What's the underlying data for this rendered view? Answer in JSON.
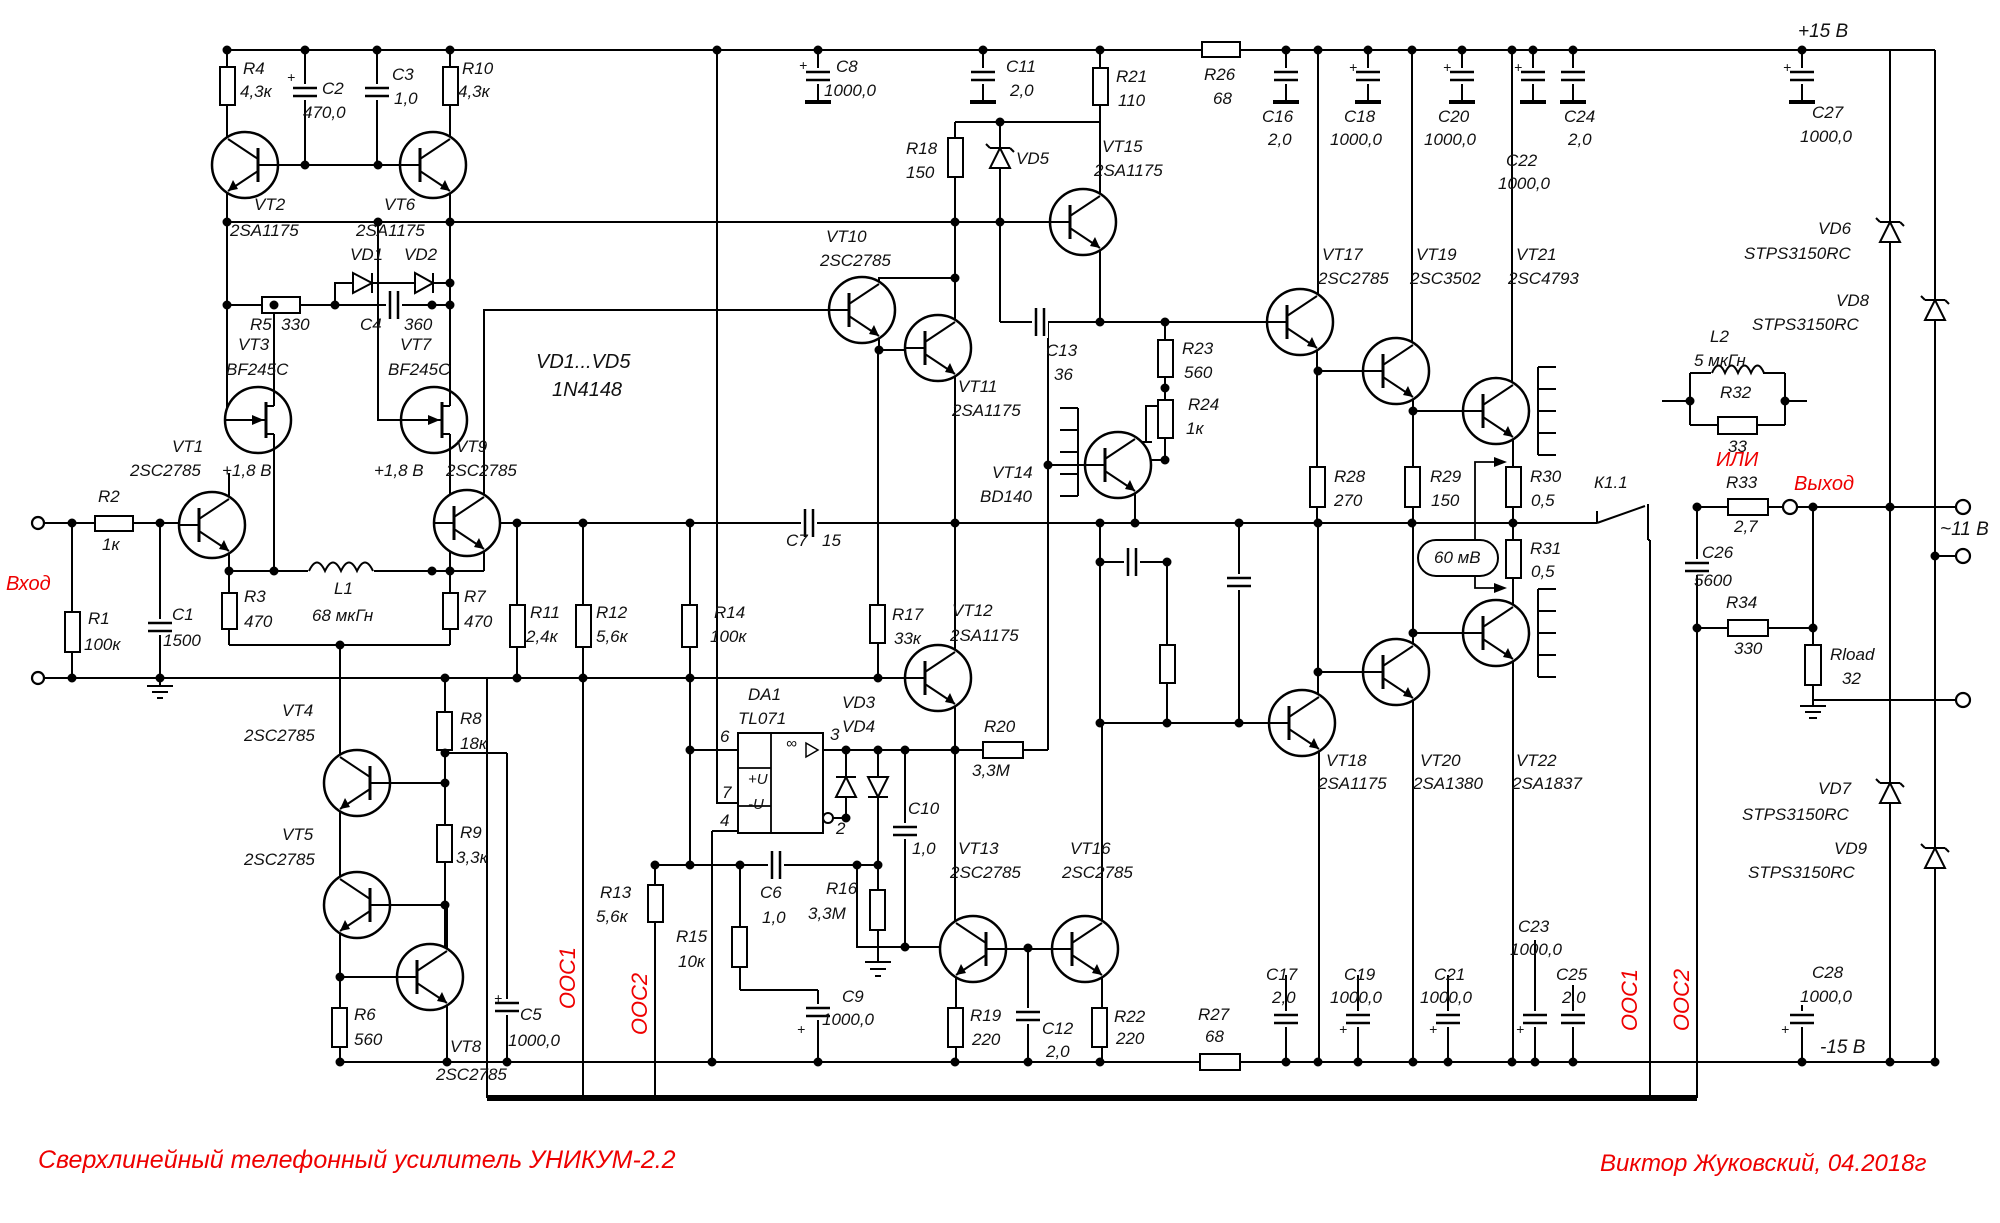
{
  "title": "Сверхлинейный телефонный усилитель УНИКУМ-2.2",
  "author": "Виктор Жуковский, 04.2018г",
  "colors": {
    "wire": "#000000",
    "label": "#111111",
    "accent": "#ee0000",
    "bg": "#ffffff"
  },
  "power": {
    "pos_rail": "+15 В",
    "neg_rail": "-15 В",
    "output_voltage": "~11 В"
  },
  "net_labels": [
    "Вход",
    "Выход",
    "ИЛИ",
    "ООС1",
    "ООС2",
    "60 мВ",
    "К1.1",
    "+1,8 В"
  ],
  "ic": {
    "ref": "DA1",
    "part": "TL071",
    "pins": [
      "6",
      "7",
      "4",
      "3",
      "2"
    ],
    "cells": [
      "+U",
      "-U",
      "∞"
    ]
  },
  "labels": [
    {
      "t": "R4",
      "x": 243,
      "y": 60
    },
    {
      "t": "4,3к",
      "x": 240,
      "y": 83
    },
    {
      "t": "C2",
      "x": 322,
      "y": 80
    },
    {
      "t": "470,0",
      "x": 303,
      "y": 104
    },
    {
      "t": "C3",
      "x": 392,
      "y": 66
    },
    {
      "t": "1,0",
      "x": 394,
      "y": 90
    },
    {
      "t": "R10",
      "x": 462,
      "y": 60
    },
    {
      "t": "4,3к",
      "x": 458,
      "y": 83
    },
    {
      "t": "VT2",
      "x": 254,
      "y": 196
    },
    {
      "t": "2SA1175",
      "x": 230,
      "y": 222
    },
    {
      "t": "VT6",
      "x": 384,
      "y": 196
    },
    {
      "t": "2SA1175",
      "x": 356,
      "y": 222
    },
    {
      "t": "VD1",
      "x": 350,
      "y": 246
    },
    {
      "t": "VD2",
      "x": 404,
      "y": 246
    },
    {
      "t": "R5  330",
      "x": 250,
      "y": 316
    },
    {
      "t": "C4",
      "x": 360,
      "y": 316
    },
    {
      "t": "360",
      "x": 404,
      "y": 316
    },
    {
      "t": "VT3",
      "x": 238,
      "y": 336
    },
    {
      "t": "BF245C",
      "x": 226,
      "y": 361
    },
    {
      "t": "VT7",
      "x": 400,
      "y": 336
    },
    {
      "t": "BF245C",
      "x": 388,
      "y": 361
    },
    {
      "t": "VD1...VD5",
      "x": 536,
      "y": 352,
      "s": 20
    },
    {
      "t": "1N4148",
      "x": 552,
      "y": 380,
      "s": 20
    },
    {
      "t": "VT1",
      "x": 172,
      "y": 438
    },
    {
      "t": "2SC2785",
      "x": 130,
      "y": 462
    },
    {
      "t": "+1,8 В",
      "x": 222,
      "y": 462
    },
    {
      "t": "+1,8 В",
      "x": 374,
      "y": 462
    },
    {
      "t": "VT9",
      "x": 456,
      "y": 438
    },
    {
      "t": "2SC2785",
      "x": 446,
      "y": 462
    },
    {
      "t": "R2",
      "x": 98,
      "y": 488
    },
    {
      "t": "1к",
      "x": 102,
      "y": 536
    },
    {
      "t": "Вход",
      "x": 6,
      "y": 574,
      "c": "r",
      "s": 20
    },
    {
      "t": "R1",
      "x": 88,
      "y": 610
    },
    {
      "t": "100к",
      "x": 84,
      "y": 636
    },
    {
      "t": "C1",
      "x": 172,
      "y": 606
    },
    {
      "t": "1500",
      "x": 163,
      "y": 632
    },
    {
      "t": "R3",
      "x": 244,
      "y": 588
    },
    {
      "t": "470",
      "x": 244,
      "y": 613
    },
    {
      "t": "L1",
      "x": 334,
      "y": 580
    },
    {
      "t": "68 мкГн",
      "x": 312,
      "y": 607
    },
    {
      "t": "R7",
      "x": 464,
      "y": 588
    },
    {
      "t": "470",
      "x": 464,
      "y": 613
    },
    {
      "t": "VT4",
      "x": 282,
      "y": 702
    },
    {
      "t": "2SC2785",
      "x": 244,
      "y": 727
    },
    {
      "t": "VT5",
      "x": 282,
      "y": 826
    },
    {
      "t": "2SC2785",
      "x": 244,
      "y": 851
    },
    {
      "t": "R8",
      "x": 460,
      "y": 710
    },
    {
      "t": "18к",
      "x": 460,
      "y": 735
    },
    {
      "t": "R9",
      "x": 460,
      "y": 824
    },
    {
      "t": "3,3к",
      "x": 456,
      "y": 849
    },
    {
      "t": "R6",
      "x": 354,
      "y": 1006
    },
    {
      "t": "560",
      "x": 354,
      "y": 1031
    },
    {
      "t": "VT8",
      "x": 450,
      "y": 1038
    },
    {
      "t": "2SC2785",
      "x": 436,
      "y": 1066
    },
    {
      "t": "C5",
      "x": 520,
      "y": 1006
    },
    {
      "t": "1000,0",
      "x": 508,
      "y": 1032
    },
    {
      "t": "ООС1",
      "x": 568,
      "y": 978,
      "c": "r",
      "s": 22,
      "v": 1
    },
    {
      "t": "ООС2",
      "x": 640,
      "y": 1004,
      "c": "r",
      "s": 22,
      "v": 1
    },
    {
      "t": "R13",
      "x": 600,
      "y": 884
    },
    {
      "t": "5,6к",
      "x": 596,
      "y": 908
    },
    {
      "t": "R15",
      "x": 676,
      "y": 928
    },
    {
      "t": "10к",
      "x": 678,
      "y": 953
    },
    {
      "t": "R11",
      "x": 530,
      "y": 604
    },
    {
      "t": "2,4к",
      "x": 526,
      "y": 628
    },
    {
      "t": "R12",
      "x": 596,
      "y": 604
    },
    {
      "t": "5,6к",
      "x": 596,
      "y": 628
    },
    {
      "t": "R14",
      "x": 714,
      "y": 604
    },
    {
      "t": "100к",
      "x": 710,
      "y": 628
    },
    {
      "t": "C7",
      "x": 786,
      "y": 532
    },
    {
      "t": "15",
      "x": 822,
      "y": 532
    },
    {
      "t": "DA1",
      "x": 748,
      "y": 686
    },
    {
      "t": "TL071",
      "x": 738,
      "y": 710
    },
    {
      "t": "6",
      "x": 720,
      "y": 728
    },
    {
      "t": "7",
      "x": 722,
      "y": 784
    },
    {
      "t": "4",
      "x": 720,
      "y": 812
    },
    {
      "t": "3",
      "x": 830,
      "y": 726
    },
    {
      "t": "2",
      "x": 836,
      "y": 820
    },
    {
      "t": "+U",
      "x": 748,
      "y": 772,
      "s": 15
    },
    {
      "t": "-U",
      "x": 748,
      "y": 797,
      "s": 15
    },
    {
      "t": "∞",
      "x": 786,
      "y": 736,
      "s": 15
    },
    {
      "t": "VD3",
      "x": 842,
      "y": 694
    },
    {
      "t": "VD4",
      "x": 842,
      "y": 718
    },
    {
      "t": "C10",
      "x": 908,
      "y": 800
    },
    {
      "t": "1,0",
      "x": 912,
      "y": 840
    },
    {
      "t": "C6",
      "x": 760,
      "y": 884
    },
    {
      "t": "1,0",
      "x": 762,
      "y": 909
    },
    {
      "t": "R16",
      "x": 826,
      "y": 880
    },
    {
      "t": "3,3М",
      "x": 808,
      "y": 905
    },
    {
      "t": "R17",
      "x": 892,
      "y": 606
    },
    {
      "t": "33к",
      "x": 894,
      "y": 630
    },
    {
      "t": "VT12",
      "x": 952,
      "y": 602
    },
    {
      "t": "2SA1175",
      "x": 950,
      "y": 627
    },
    {
      "t": "R20",
      "x": 984,
      "y": 718
    },
    {
      "t": "3,3М",
      "x": 972,
      "y": 762
    },
    {
      "t": "VT13",
      "x": 958,
      "y": 840
    },
    {
      "t": "2SC2785",
      "x": 950,
      "y": 864
    },
    {
      "t": "VT16",
      "x": 1070,
      "y": 840
    },
    {
      "t": "2SC2785",
      "x": 1062,
      "y": 864
    },
    {
      "t": "C9",
      "x": 842,
      "y": 988
    },
    {
      "t": "1000,0",
      "x": 822,
      "y": 1011
    },
    {
      "t": "R19",
      "x": 970,
      "y": 1007
    },
    {
      "t": "220",
      "x": 972,
      "y": 1031
    },
    {
      "t": "C12",
      "x": 1042,
      "y": 1020
    },
    {
      "t": "2,0",
      "x": 1046,
      "y": 1043
    },
    {
      "t": "R22",
      "x": 1114,
      "y": 1008
    },
    {
      "t": "220",
      "x": 1116,
      "y": 1030
    },
    {
      "t": "R27",
      "x": 1198,
      "y": 1006
    },
    {
      "t": "68",
      "x": 1205,
      "y": 1028
    },
    {
      "t": "C8",
      "x": 836,
      "y": 58
    },
    {
      "t": "1000,0",
      "x": 824,
      "y": 82
    },
    {
      "t": "C11",
      "x": 1006,
      "y": 58
    },
    {
      "t": "2,0",
      "x": 1010,
      "y": 82
    },
    {
      "t": "R18",
      "x": 906,
      "y": 140
    },
    {
      "t": "150",
      "x": 906,
      "y": 164
    },
    {
      "t": "VD5",
      "x": 1016,
      "y": 150
    },
    {
      "t": "VT10",
      "x": 826,
      "y": 228
    },
    {
      "t": "2SC2785",
      "x": 820,
      "y": 252
    },
    {
      "t": "VT11",
      "x": 958,
      "y": 378
    },
    {
      "t": "2SA1175",
      "x": 952,
      "y": 402
    },
    {
      "t": "C13",
      "x": 1046,
      "y": 342
    },
    {
      "t": "36",
      "x": 1054,
      "y": 366
    },
    {
      "t": "VT14",
      "x": 992,
      "y": 464
    },
    {
      "t": "BD140",
      "x": 980,
      "y": 488
    },
    {
      "t": "R23",
      "x": 1182,
      "y": 340
    },
    {
      "t": "560",
      "x": 1184,
      "y": 364
    },
    {
      "t": "R24",
      "x": 1188,
      "y": 396
    },
    {
      "t": "1к",
      "x": 1186,
      "y": 420
    },
    {
      "t": "VT15",
      "x": 1102,
      "y": 138
    },
    {
      "t": "2SA1175",
      "x": 1094,
      "y": 162
    },
    {
      "t": "R21",
      "x": 1116,
      "y": 68
    },
    {
      "t": "110",
      "x": 1118,
      "y": 92
    },
    {
      "t": "R26",
      "x": 1204,
      "y": 66
    },
    {
      "t": "68",
      "x": 1213,
      "y": 90
    },
    {
      "t": "C16",
      "x": 1262,
      "y": 108
    },
    {
      "t": "2,0",
      "x": 1268,
      "y": 131
    },
    {
      "t": "C18",
      "x": 1344,
      "y": 108
    },
    {
      "t": "1000,0",
      "x": 1330,
      "y": 131
    },
    {
      "t": "C20",
      "x": 1438,
      "y": 108
    },
    {
      "t": "1000,0",
      "x": 1424,
      "y": 131
    },
    {
      "t": "C22",
      "x": 1506,
      "y": 152
    },
    {
      "t": "1000,0",
      "x": 1498,
      "y": 175
    },
    {
      "t": "C24",
      "x": 1564,
      "y": 108
    },
    {
      "t": "2,0",
      "x": 1568,
      "y": 131
    },
    {
      "t": "C27",
      "x": 1812,
      "y": 104
    },
    {
      "t": "1000,0",
      "x": 1800,
      "y": 128
    },
    {
      "t": "+15 В",
      "x": 1798,
      "y": 22,
      "s": 19
    },
    {
      "t": "VT17",
      "x": 1322,
      "y": 246
    },
    {
      "t": "2SC2785",
      "x": 1318,
      "y": 270
    },
    {
      "t": "VT19",
      "x": 1416,
      "y": 246
    },
    {
      "t": "2SC3502",
      "x": 1410,
      "y": 270
    },
    {
      "t": "VT21",
      "x": 1516,
      "y": 246
    },
    {
      "t": "2SC4793",
      "x": 1508,
      "y": 270
    },
    {
      "t": "VD6",
      "x": 1818,
      "y": 220
    },
    {
      "t": "STPS3150RC",
      "x": 1744,
      "y": 245
    },
    {
      "t": "VD8",
      "x": 1836,
      "y": 292
    },
    {
      "t": "STPS3150RC",
      "x": 1752,
      "y": 316
    },
    {
      "t": "L2",
      "x": 1710,
      "y": 328
    },
    {
      "t": "5 мкГн",
      "x": 1694,
      "y": 352
    },
    {
      "t": "R32",
      "x": 1720,
      "y": 384
    },
    {
      "t": "33",
      "x": 1728,
      "y": 438
    },
    {
      "t": "ИЛИ",
      "x": 1716,
      "y": 450,
      "c": "r",
      "s": 20
    },
    {
      "t": "R33",
      "x": 1726,
      "y": 474
    },
    {
      "t": "2,7",
      "x": 1734,
      "y": 518
    },
    {
      "t": "Выход",
      "x": 1794,
      "y": 474,
      "c": "r",
      "s": 20
    },
    {
      "t": "К1.1",
      "x": 1594,
      "y": 474
    },
    {
      "t": "C26",
      "x": 1702,
      "y": 544
    },
    {
      "t": "5600",
      "x": 1694,
      "y": 572
    },
    {
      "t": "R34",
      "x": 1726,
      "y": 594
    },
    {
      "t": "330",
      "x": 1734,
      "y": 640
    },
    {
      "t": "Rload",
      "x": 1830,
      "y": 646
    },
    {
      "t": "32",
      "x": 1842,
      "y": 670
    },
    {
      "t": "~11 В",
      "x": 1940,
      "y": 520,
      "s": 19
    },
    {
      "t": "R28",
      "x": 1334,
      "y": 468
    },
    {
      "t": "270",
      "x": 1334,
      "y": 492
    },
    {
      "t": "R29",
      "x": 1430,
      "y": 468
    },
    {
      "t": "150",
      "x": 1431,
      "y": 492
    },
    {
      "t": "R30",
      "x": 1530,
      "y": 468
    },
    {
      "t": "0,5",
      "x": 1531,
      "y": 492
    },
    {
      "t": "R31",
      "x": 1530,
      "y": 540
    },
    {
      "t": "0,5",
      "x": 1531,
      "y": 563
    },
    {
      "t": "60 мВ",
      "x": 1434,
      "y": 549
    },
    {
      "t": "VT18",
      "x": 1326,
      "y": 752
    },
    {
      "t": "2SA1175",
      "x": 1318,
      "y": 775
    },
    {
      "t": "VT20",
      "x": 1420,
      "y": 752
    },
    {
      "t": "2SA1380",
      "x": 1413,
      "y": 775
    },
    {
      "t": "VT22",
      "x": 1516,
      "y": 752
    },
    {
      "t": "2SA1837",
      "x": 1512,
      "y": 775
    },
    {
      "t": "C23",
      "x": 1518,
      "y": 918
    },
    {
      "t": "1000,0",
      "x": 1510,
      "y": 941
    },
    {
      "t": "C17",
      "x": 1266,
      "y": 966
    },
    {
      "t": "2,0",
      "x": 1272,
      "y": 989
    },
    {
      "t": "C19",
      "x": 1344,
      "y": 966
    },
    {
      "t": "1000,0",
      "x": 1330,
      "y": 989
    },
    {
      "t": "C21",
      "x": 1434,
      "y": 966
    },
    {
      "t": "1000,0",
      "x": 1420,
      "y": 989
    },
    {
      "t": "C25",
      "x": 1556,
      "y": 966
    },
    {
      "t": "2,0",
      "x": 1562,
      "y": 989
    },
    {
      "t": "ООС1",
      "x": 1630,
      "y": 1000,
      "c": "r",
      "s": 22,
      "v": 1
    },
    {
      "t": "ООС2",
      "x": 1682,
      "y": 1000,
      "c": "r",
      "s": 22,
      "v": 1
    },
    {
      "t": "VD7",
      "x": 1818,
      "y": 780
    },
    {
      "t": "STPS3150RC",
      "x": 1742,
      "y": 806
    },
    {
      "t": "VD9",
      "x": 1834,
      "y": 840
    },
    {
      "t": "STPS3150RC",
      "x": 1748,
      "y": 864
    },
    {
      "t": "C28",
      "x": 1812,
      "y": 964
    },
    {
      "t": "1000,0",
      "x": 1800,
      "y": 988
    },
    {
      "t": "-15 В",
      "x": 1820,
      "y": 1038,
      "s": 19
    },
    {
      "t": "+",
      "x": 287,
      "y": 70,
      "s": 14
    },
    {
      "t": "+",
      "x": 494,
      "y": 991,
      "s": 14
    },
    {
      "t": "+",
      "x": 799,
      "y": 58,
      "s": 14
    },
    {
      "t": "+",
      "x": 797,
      "y": 1022,
      "s": 14
    },
    {
      "t": "+",
      "x": 1349,
      "y": 60,
      "s": 14
    },
    {
      "t": "+",
      "x": 1339,
      "y": 1022,
      "s": 14
    },
    {
      "t": "+",
      "x": 1443,
      "y": 60,
      "s": 14
    },
    {
      "t": "+",
      "x": 1429,
      "y": 1022,
      "s": 14
    },
    {
      "t": "+",
      "x": 1514,
      "y": 60,
      "s": 14
    },
    {
      "t": "+",
      "x": 1516,
      "y": 1022,
      "s": 14
    },
    {
      "t": "+",
      "x": 1783,
      "y": 60,
      "s": 14
    },
    {
      "t": "+",
      "x": 1781,
      "y": 1022,
      "s": 14
    }
  ]
}
